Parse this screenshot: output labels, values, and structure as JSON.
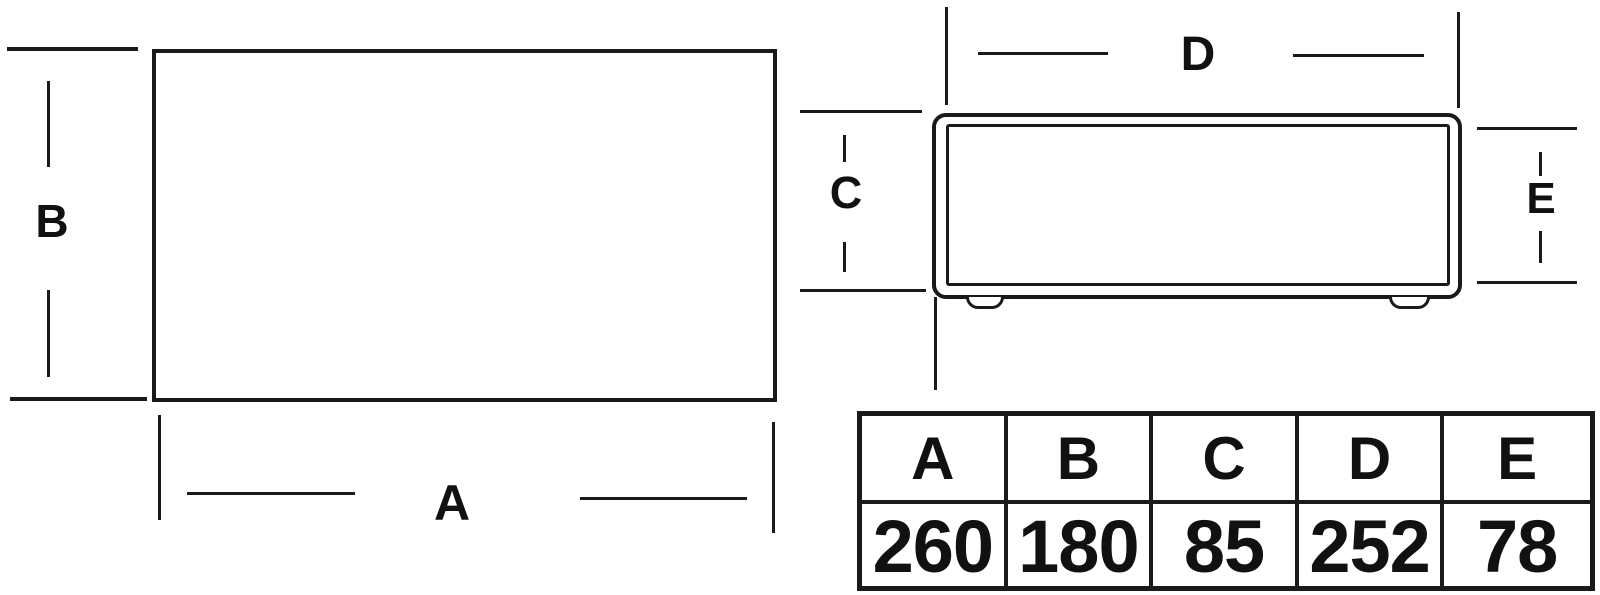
{
  "colors": {
    "line": "#1a1a1a",
    "background": "#ffffff"
  },
  "dimension_labels": {
    "a": "A",
    "b": "B",
    "c": "C",
    "d": "D",
    "e": "E"
  },
  "table": {
    "headers": [
      "A",
      "B",
      "C",
      "D",
      "E"
    ],
    "values": [
      "260",
      "180",
      "85",
      "252",
      "78"
    ]
  }
}
